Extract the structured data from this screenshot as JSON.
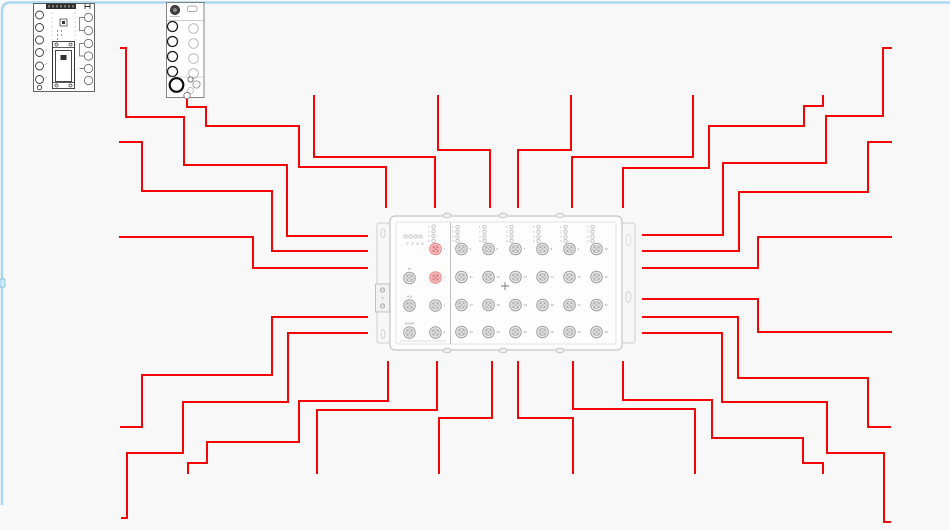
{
  "canvas": {
    "background": "#f8f8f9",
    "frame": {
      "color": "#a9d7ef",
      "top_y": 2.5,
      "left_x": 2,
      "corner_radius": 9,
      "left_end_y": 505,
      "handle": {
        "x": 0,
        "y": 279,
        "w": 5,
        "h": 8,
        "fill": "#cdeaf7",
        "stroke": "#7fbcd9"
      }
    }
  },
  "wires": {
    "color": "#f40505",
    "width": 2,
    "items": [
      {
        "id": "L1",
        "points": [
          [
            120,
            48
          ],
          [
            126,
            48
          ],
          [
            126,
            117
          ],
          [
            184,
            117
          ],
          [
            184,
            165
          ],
          [
            287,
            165
          ],
          [
            287,
            236
          ],
          [
            368,
            236
          ]
        ]
      },
      {
        "id": "L2",
        "points": [
          [
            119,
            142
          ],
          [
            142,
            142
          ],
          [
            142,
            191
          ],
          [
            272,
            191
          ],
          [
            272,
            251
          ],
          [
            368,
            251
          ]
        ]
      },
      {
        "id": "L3",
        "points": [
          [
            119,
            237
          ],
          [
            253,
            237
          ],
          [
            253,
            268
          ],
          [
            368,
            268
          ]
        ]
      },
      {
        "id": "L4",
        "points": [
          [
            187,
            97
          ],
          [
            187,
            107
          ],
          [
            206,
            107
          ],
          [
            206,
            126
          ],
          [
            299,
            126
          ],
          [
            299,
            167
          ],
          [
            386,
            167
          ],
          [
            386,
            208
          ]
        ]
      },
      {
        "id": "L5",
        "points": [
          [
            314,
            95
          ],
          [
            314,
            157
          ],
          [
            435,
            157
          ],
          [
            435,
            208
          ]
        ]
      },
      {
        "id": "L6",
        "points": [
          [
            438,
            95
          ],
          [
            438,
            150
          ],
          [
            490,
            150
          ],
          [
            490,
            208
          ]
        ]
      },
      {
        "id": "L7",
        "points": [
          [
            571,
            95
          ],
          [
            571,
            150
          ],
          [
            518,
            150
          ],
          [
            518,
            208
          ]
        ]
      },
      {
        "id": "L8",
        "points": [
          [
            693,
            95
          ],
          [
            693,
            157
          ],
          [
            572,
            157
          ],
          [
            572,
            208
          ]
        ]
      },
      {
        "id": "L9",
        "points": [
          [
            823,
            95
          ],
          [
            823,
            106
          ],
          [
            804,
            106
          ],
          [
            804,
            126
          ],
          [
            709,
            126
          ],
          [
            709,
            168
          ],
          [
            623,
            168
          ],
          [
            623,
            208
          ]
        ]
      },
      {
        "id": "R1",
        "points": [
          [
            642,
            235
          ],
          [
            723,
            235
          ],
          [
            723,
            163
          ],
          [
            826,
            163
          ],
          [
            826,
            116
          ],
          [
            883,
            116
          ],
          [
            883,
            48
          ],
          [
            892,
            48
          ]
        ]
      },
      {
        "id": "R2",
        "points": [
          [
            642,
            251
          ],
          [
            739,
            251
          ],
          [
            739,
            192
          ],
          [
            868,
            192
          ],
          [
            868,
            142
          ],
          [
            892,
            142
          ]
        ]
      },
      {
        "id": "R3",
        "points": [
          [
            642,
            268
          ],
          [
            758,
            268
          ],
          [
            758,
            237
          ],
          [
            892,
            237
          ]
        ]
      },
      {
        "id": "R4",
        "points": [
          [
            642,
            299
          ],
          [
            758,
            299
          ],
          [
            758,
            332
          ],
          [
            892,
            332
          ]
        ]
      },
      {
        "id": "R5",
        "points": [
          [
            642,
            317
          ],
          [
            738,
            317
          ],
          [
            738,
            378
          ],
          [
            868,
            378
          ],
          [
            868,
            427
          ],
          [
            891,
            427
          ]
        ]
      },
      {
        "id": "R6",
        "points": [
          [
            642,
            333
          ],
          [
            722,
            333
          ],
          [
            722,
            402
          ],
          [
            827,
            402
          ],
          [
            827,
            453
          ],
          [
            884,
            453
          ],
          [
            884,
            522
          ],
          [
            891,
            522
          ]
        ]
      },
      {
        "id": "D1",
        "points": [
          [
            368,
            317
          ],
          [
            272,
            317
          ],
          [
            272,
            375
          ],
          [
            142,
            375
          ],
          [
            142,
            427
          ],
          [
            120,
            427
          ]
        ]
      },
      {
        "id": "D2",
        "points": [
          [
            368,
            333
          ],
          [
            288,
            333
          ],
          [
            288,
            402
          ],
          [
            183,
            402
          ],
          [
            183,
            453
          ],
          [
            127,
            453
          ],
          [
            127,
            518
          ],
          [
            121,
            518
          ]
        ]
      },
      {
        "id": "B1",
        "points": [
          [
            388,
            361
          ],
          [
            388,
            401
          ],
          [
            299,
            401
          ],
          [
            299,
            442
          ],
          [
            207,
            442
          ],
          [
            207,
            463
          ],
          [
            188,
            463
          ],
          [
            188,
            474
          ]
        ]
      },
      {
        "id": "B2",
        "points": [
          [
            437,
            361
          ],
          [
            437,
            410
          ],
          [
            317,
            410
          ],
          [
            317,
            474
          ]
        ]
      },
      {
        "id": "B3",
        "points": [
          [
            492,
            361
          ],
          [
            492,
            418
          ],
          [
            439,
            418
          ],
          [
            439,
            474
          ]
        ]
      },
      {
        "id": "B4",
        "points": [
          [
            518,
            361
          ],
          [
            518,
            418
          ],
          [
            573,
            418
          ],
          [
            573,
            474
          ]
        ]
      },
      {
        "id": "B5",
        "points": [
          [
            573,
            361
          ],
          [
            573,
            409
          ],
          [
            695,
            409
          ],
          [
            695,
            474
          ]
        ]
      },
      {
        "id": "B6",
        "points": [
          [
            623,
            361
          ],
          [
            623,
            400
          ],
          [
            712,
            400
          ],
          [
            712,
            438
          ],
          [
            803,
            438
          ],
          [
            803,
            463
          ],
          [
            823,
            463
          ],
          [
            823,
            474
          ]
        ]
      }
    ]
  },
  "distribution_box": {
    "name": "distribution-box",
    "center_mark": {
      "x": 505,
      "y": 286
    },
    "left_section": {
      "status_led_row": {
        "x": 405.5,
        "y": 236.5,
        "spacing": 5,
        "labels": [
          "P1",
          "P2",
          "BF",
          "SF"
        ]
      },
      "led_column": {
        "x": 433.5,
        "y": 226.5,
        "spacing": 4.8,
        "labels": [
          "1",
          "2",
          "3",
          "4"
        ]
      },
      "labeled_ports": [
        {
          "label": "TX",
          "x": 409.5,
          "y": 278
        },
        {
          "label": "AUX",
          "x": 409.5,
          "y": 305.5
        },
        {
          "label": "POWER",
          "x": 409.5,
          "y": 332.5
        }
      ],
      "numbered_ports": [
        {
          "number": "1",
          "x": 435.5,
          "y": 249,
          "highlight": true
        },
        {
          "number": "2",
          "x": 435.5,
          "y": 277.5,
          "highlight": true
        },
        {
          "number": "3",
          "x": 435.5,
          "y": 305.5,
          "highlight": false
        },
        {
          "number": "4",
          "x": 435.5,
          "y": 332.5,
          "highlight": false
        }
      ]
    },
    "grid": {
      "cols": [
        461.5,
        488.5,
        515.5,
        542.5,
        569.5,
        596.5
      ],
      "rows": [
        249,
        277,
        305,
        332
      ],
      "led_labels": [
        "1",
        "2",
        "3",
        "4"
      ],
      "port_numbers": [
        [
          "5",
          "6",
          "7",
          "8",
          "9",
          "10"
        ],
        [
          "11",
          "12",
          "13",
          "14",
          "15",
          "16"
        ],
        [
          "17",
          "18",
          "19",
          "20",
          "21",
          "22"
        ],
        [
          "23",
          "24",
          "25",
          "26",
          "27",
          "28"
        ]
      ]
    },
    "colors": {
      "port_stroke": "#9f9f9f",
      "port_fill": "#ebebeb",
      "port_inner_stroke": "#b3b3b3",
      "port_inner_fill": "#dcdcdc",
      "pin_fill": "#a6a6a6",
      "pink_stroke": "#e88b8b",
      "pink_fill": "#f7c0c0",
      "pink_inner_stroke": "#ee9f9f",
      "pink_inner_fill": "#f3acac",
      "pink_pin_fill": "#dd6666",
      "led_stroke": "#b8b8b8",
      "led_fill": "#f5f5f5",
      "label_color": "#8a8a8a"
    }
  },
  "side_devices": {
    "device1_name": "controller-module",
    "device2_name": "io-module"
  }
}
